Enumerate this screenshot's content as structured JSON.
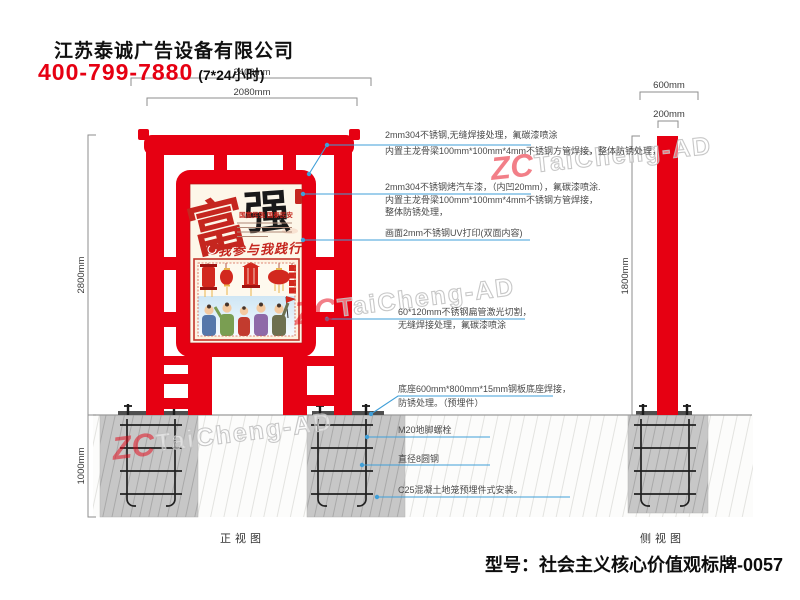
{
  "header": {
    "company": "江苏泰诚广告设备有限公司",
    "phone": "400-799-7880",
    "hours": "(7*24小时)"
  },
  "dimensions": {
    "front_overall": "2400mm",
    "frame_width": "2080mm",
    "front_height": "2800mm",
    "foundation_depth": "1000mm",
    "base_width": "600mm",
    "column_width": "200mm",
    "side_height": "1800mm"
  },
  "annotations": [
    {
      "line1": "2mm304不锈钢,无缝焊接处理，氟碳漆喷涂",
      "line2": "内置主龙骨梁100mm*100mm*4mm不锈钢方管焊接，整体防锈处理，"
    },
    {
      "line1": "2mm304不锈钢烤汽车漆，（内凹20mm），氟碳漆喷涂.",
      "line2": "内置主龙骨梁100mm*100mm*4mm不锈钢方管焊接，",
      "line3": "整体防锈处理，"
    },
    {
      "line1": "画面2mm不锈钢UV打印(双面内容)"
    },
    {
      "line1": "60*120mm不锈钢扁管激光切割，",
      "line2": "无缝焊接处理，氟碳漆喷涂"
    },
    {
      "line1": "底座600mm*800mm*15mm钢板底座焊接，",
      "line2": "防锈处理。（预埋件）"
    },
    {
      "line1": "M20地脚螺栓"
    },
    {
      "line1": "直径8圆钢"
    },
    {
      "line1": "C25混凝土地笼预埋件式安装。"
    }
  ],
  "views": {
    "front": "正视图",
    "side": "侧视图"
  },
  "poster": {
    "char1": "富",
    "char2": "强",
    "subtitle": "国富民强 国泰民安",
    "slogan": "我参与我践行"
  },
  "footer": {
    "model": "型号：社会主义核心价值观标牌-0057"
  },
  "watermark": {
    "logo": "ZC",
    "text": "TaiCheng-AD"
  },
  "colors": {
    "red": "#e60012",
    "leader_blue": "#3f9fd8"
  }
}
